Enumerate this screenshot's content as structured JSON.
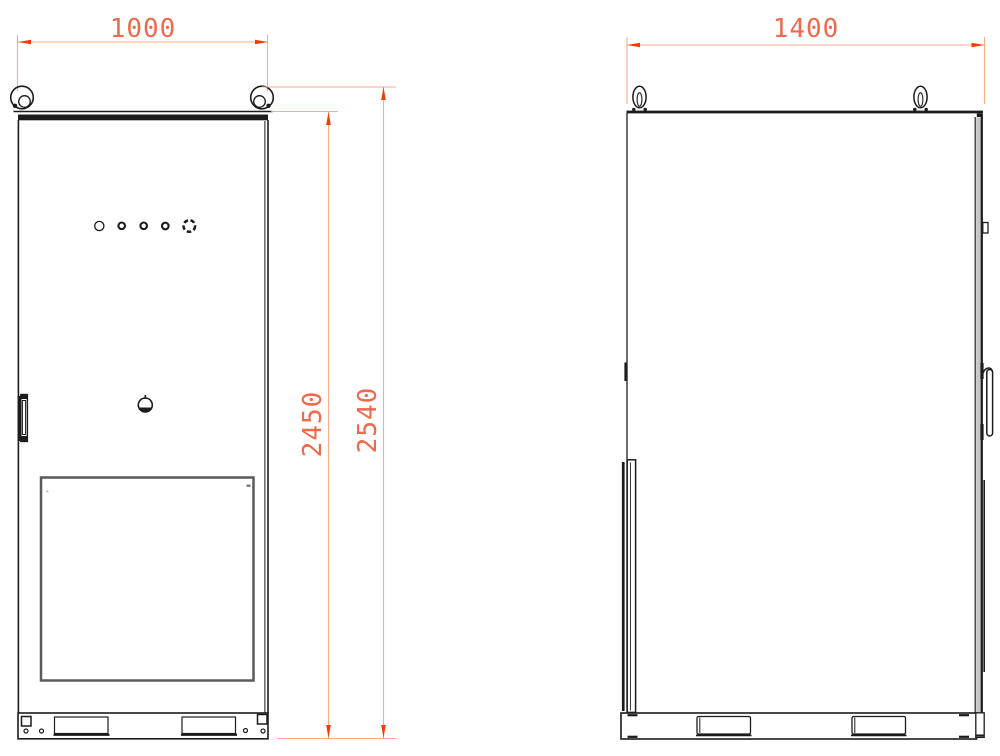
{
  "drawing": {
    "type": "technical-drawing",
    "description": "Two-view CAD dimension drawing of an outdoor equipment cabinet (front view and side view)",
    "views": {
      "front": {
        "label": "front-view",
        "width_dim": "1000",
        "body_height_dim": "2450",
        "overall_height_dim": "2540"
      },
      "side": {
        "label": "side-view",
        "depth_dim": "1400"
      }
    },
    "colors": {
      "line": "#1c1c1c",
      "dim_line": "#f8ab90",
      "dim_arrow": "#f43b07",
      "dim_text": "#ef6a4d",
      "panel_gray": "#c6c6c6",
      "window_frame": "#5a5a5a",
      "background": "#ffffff"
    }
  }
}
